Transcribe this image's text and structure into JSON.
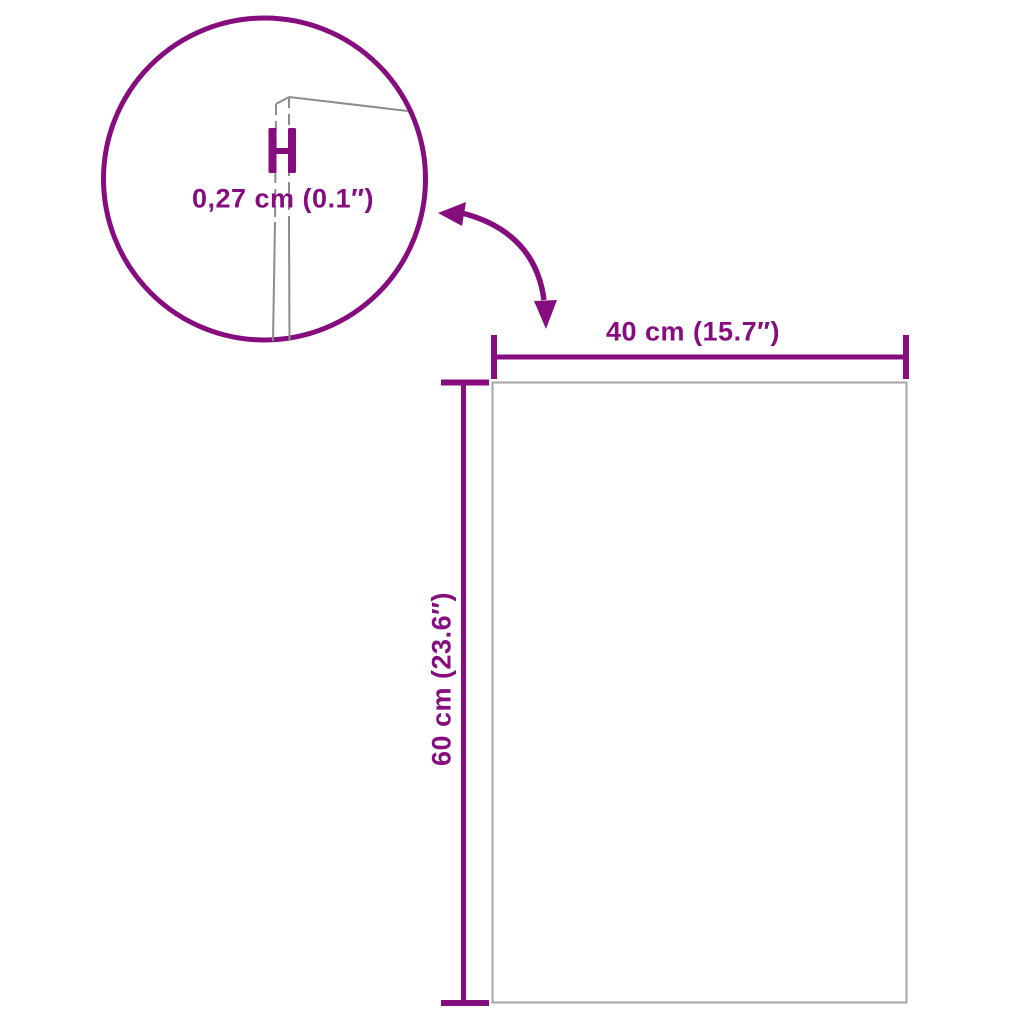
{
  "detail_view": {
    "thickness_label": "0,27 cm (0.1″)"
  },
  "dimensions": {
    "width_label": "40 cm (15.7″)",
    "height_label": "60 cm (23.6″)"
  },
  "icons": {
    "zoom_detail_circle": "magnified-edge-detail-circle",
    "curved_arrow": "curved-double-headed-arrow",
    "thickness_marker": "h-shaped-dimension-marker"
  },
  "colors": {
    "accent_purple": "#860D7E",
    "panel_outline_gray": "#A5A5A5",
    "panel_edge_gray": "#8C8C8C",
    "background": "#FFFFFF"
  }
}
